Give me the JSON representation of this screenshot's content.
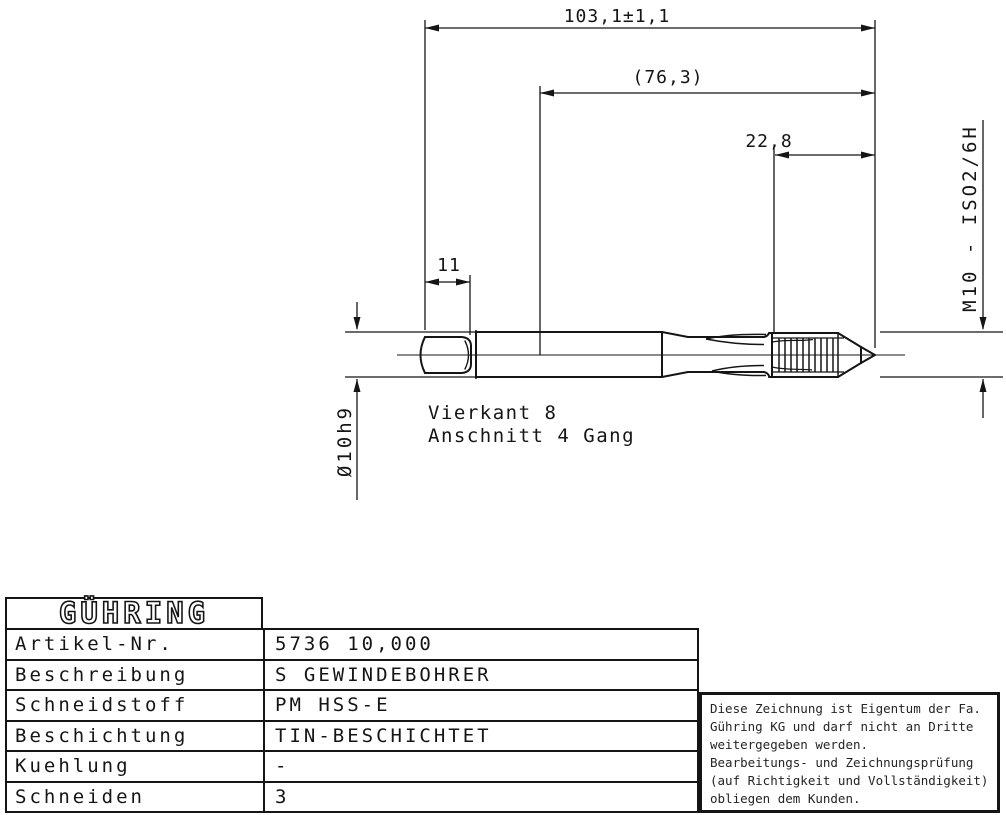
{
  "drawing": {
    "dim_overall": "103,1±1,1",
    "dim_ref": "(76,3)",
    "dim_thread": "22,8",
    "dim_square": "11",
    "thread_spec": "M10 - ISO2/6H",
    "shank_dia": "Ø10h9",
    "label_square": "Vierkant 8",
    "label_chamfer": "Anschnitt 4 Gang"
  },
  "table": {
    "logo": "GÜHRING",
    "rows": [
      {
        "label": "Artikel-Nr.",
        "value": "5736 10,000"
      },
      {
        "label": "Beschreibung",
        "value": "S GEWINDEBOHRER"
      },
      {
        "label": "Schneidstoff",
        "value": "PM HSS-E"
      },
      {
        "label": "Beschichtung",
        "value": "TIN-BESCHICHTET"
      },
      {
        "label": "Kuehlung",
        "value": "-"
      },
      {
        "label": "Schneiden",
        "value": "3"
      }
    ]
  },
  "note": {
    "lines": [
      "Diese Zeichnung ist Eigentum der Fa.",
      "Gühring KG und darf nicht an Dritte",
      "weitergegeben werden.",
      "Bearbeitungs- und Zeichnungsprüfung",
      "(auf Richtigkeit und Vollständigkeit)",
      "obliegen dem Kunden."
    ]
  },
  "colors": {
    "ink": "#151515",
    "paper": "#ffffff"
  }
}
